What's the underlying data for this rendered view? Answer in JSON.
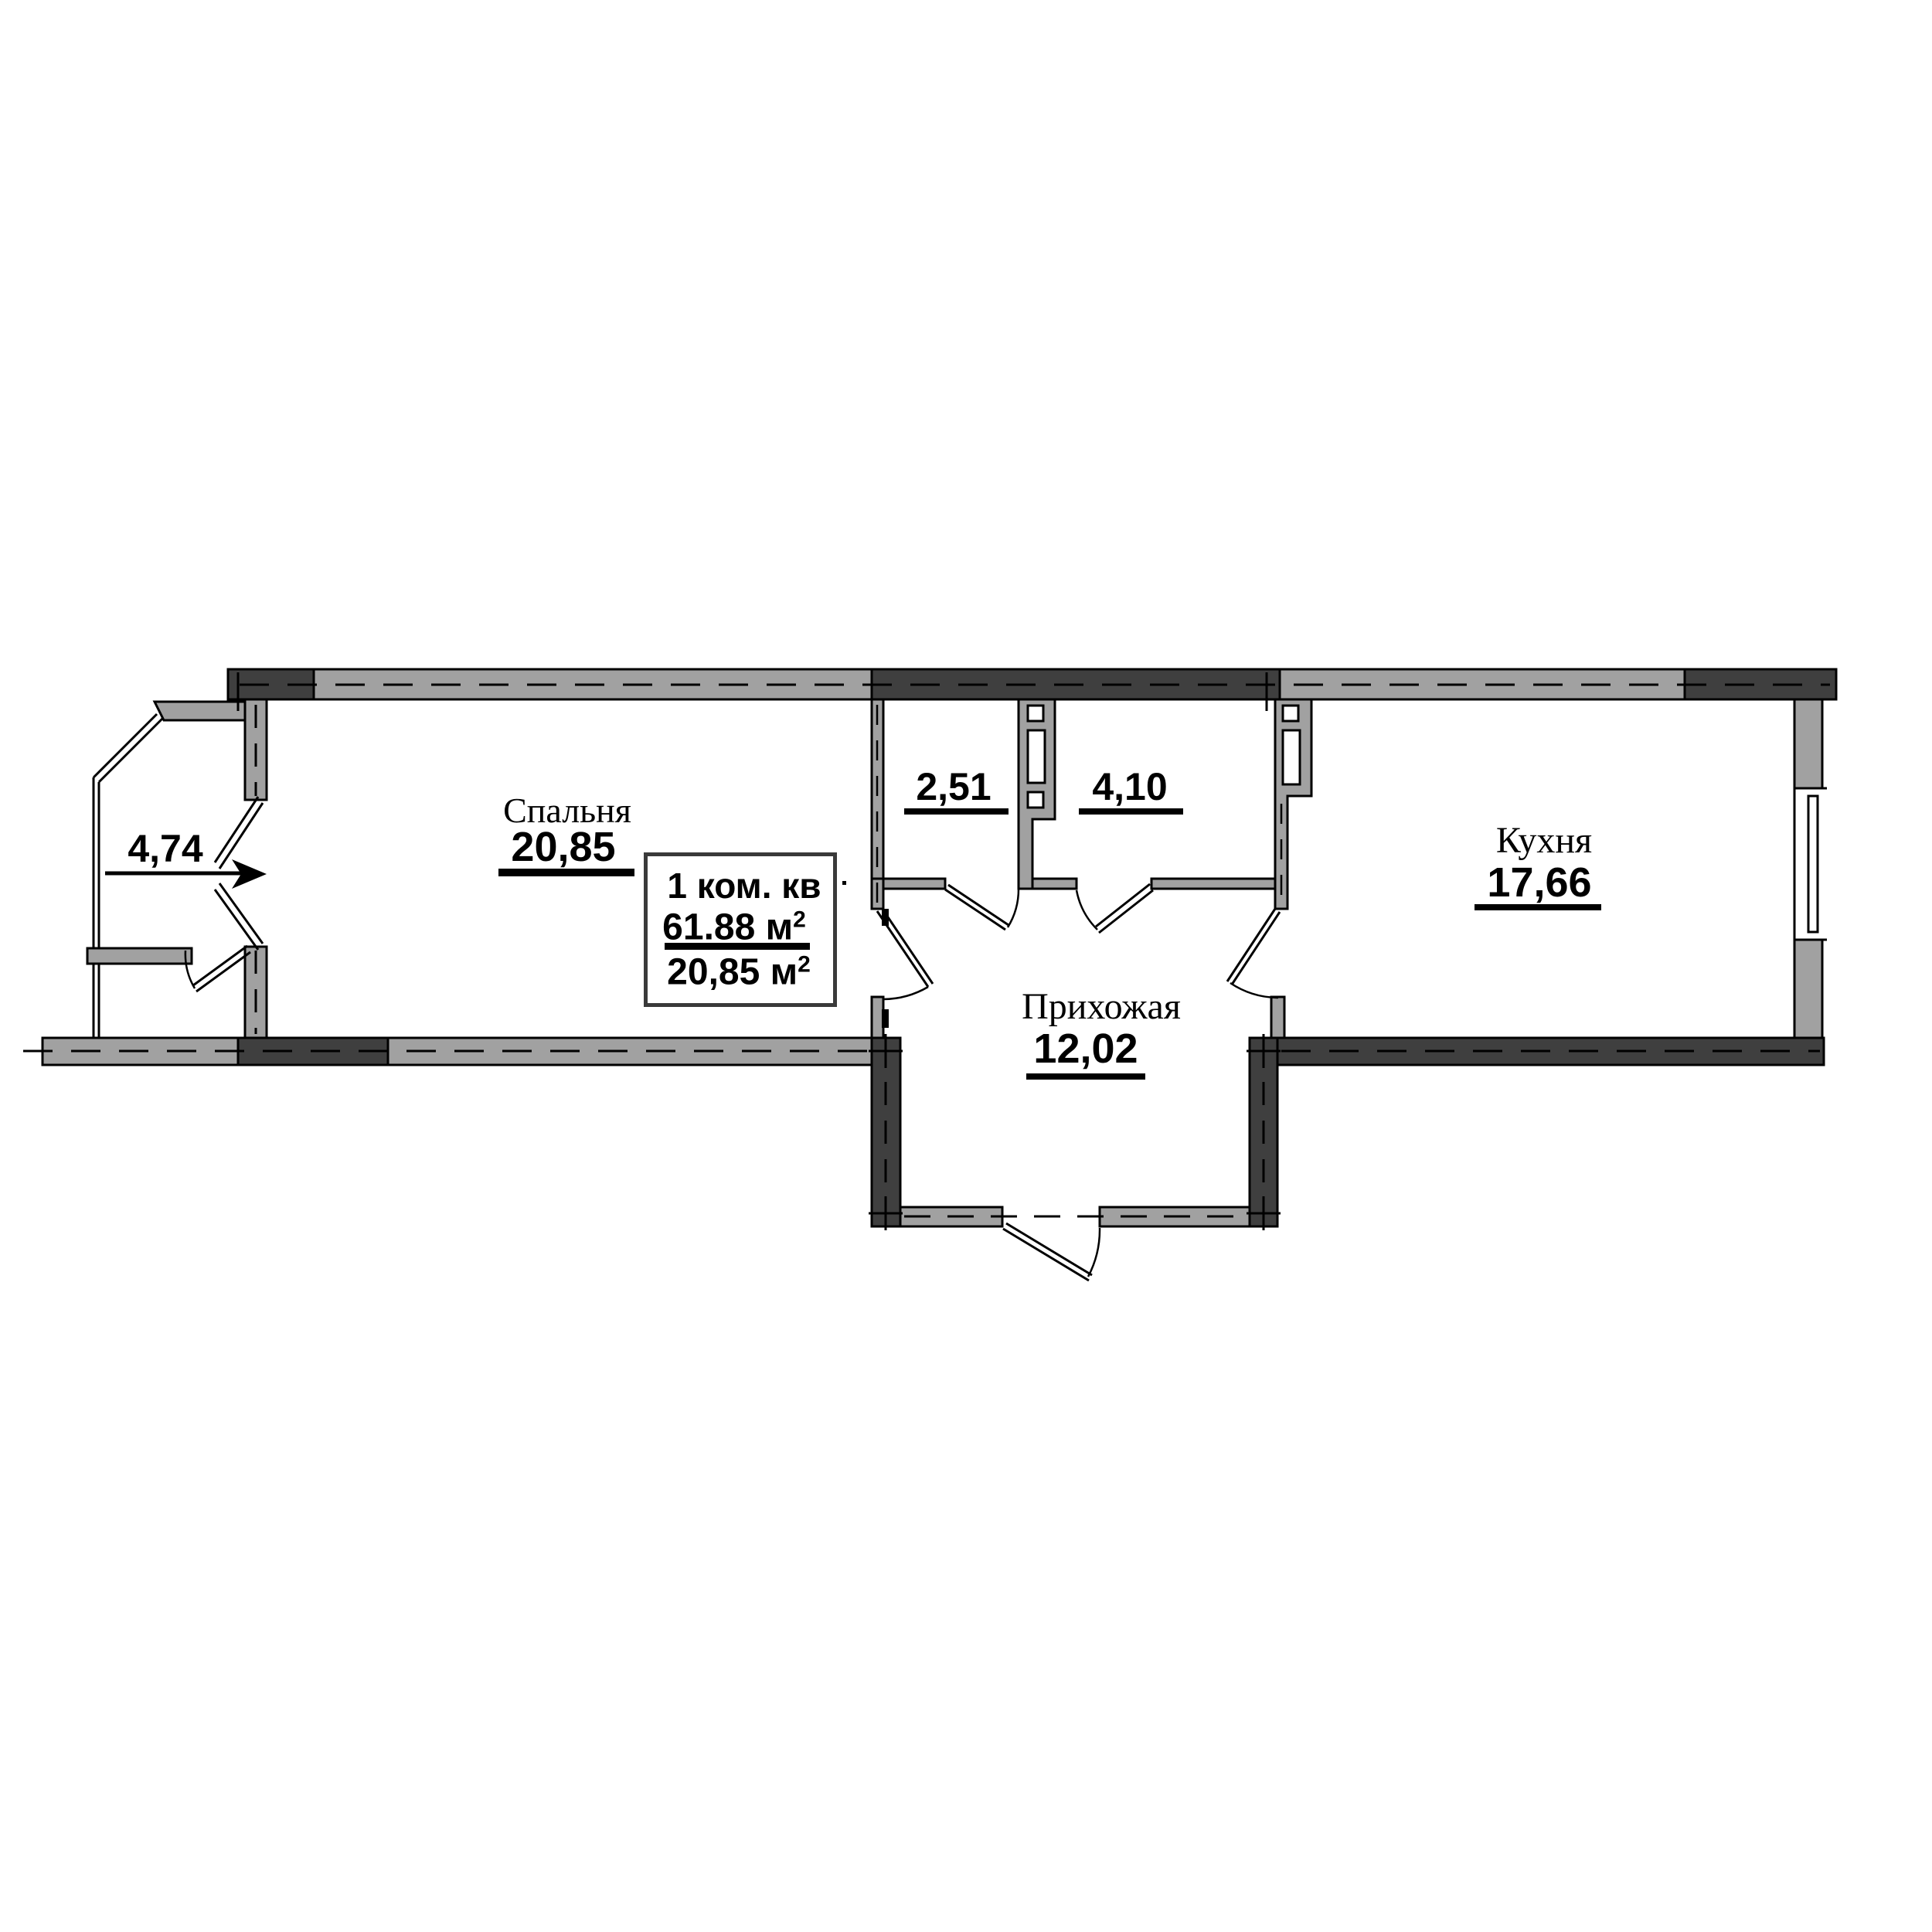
{
  "drawing": {
    "type": "apartment-floor-plan",
    "colors": {
      "wall_dark": "#3f3f3f",
      "wall_light": "#a1a1a1",
      "line": "#000000",
      "background": "#ffffff"
    },
    "rooms": {
      "bedroom": {
        "name": "Спальня",
        "area": "20,85"
      },
      "balcony": {
        "name": "",
        "area": "4,74"
      },
      "wc": {
        "name": "",
        "area": "2,51"
      },
      "bathroom": {
        "name": "",
        "area": "4,10"
      },
      "hallway": {
        "name": "Прихожая",
        "area": "12,02"
      },
      "kitchen": {
        "name": "Кухня",
        "area": "17,66"
      }
    },
    "info_box": {
      "title": "1 ком. кв",
      "total_area": "61.88 м",
      "total_area_sup": "2",
      "living_area": "20,85 м",
      "living_area_sup": "2"
    }
  }
}
